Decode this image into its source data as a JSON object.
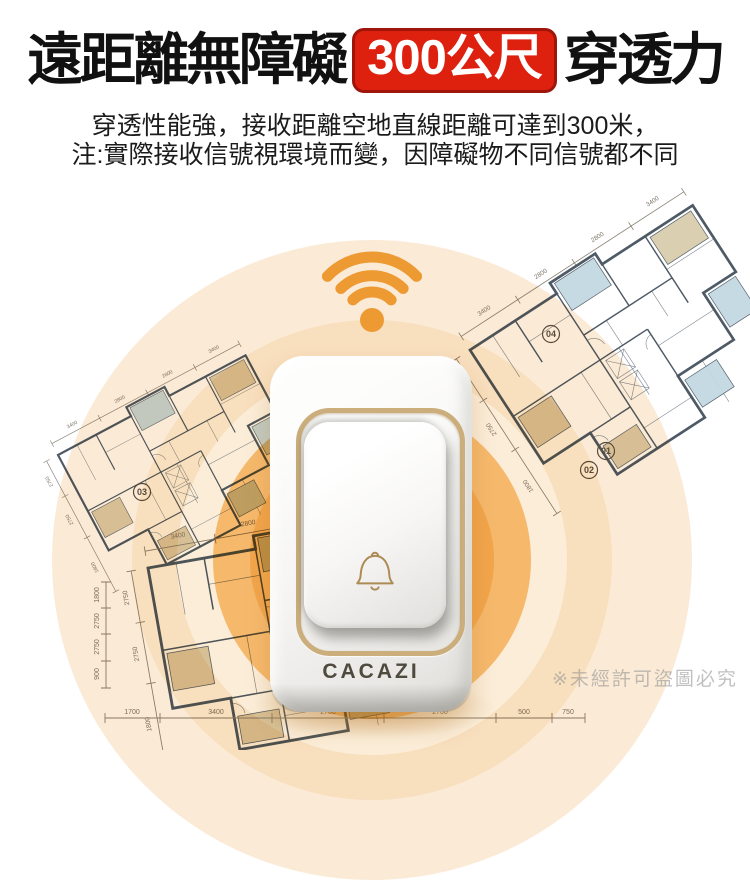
{
  "header": {
    "title_left": "遠距離無障礙",
    "badge": "300公尺",
    "title_right": "穿透力",
    "subtitle_line1": "穿透性能強，接收距離空地直線距離可達到300米，",
    "subtitle_line2": "注:實際接收信號視環境而變，因障礙物不同信號都不同"
  },
  "device": {
    "brand": "CACAZI"
  },
  "scene": {
    "watermark": "※未經許可盜圖必究"
  },
  "icons": {
    "wifi": "wifi-signal-icon",
    "bell": "doorbell-bell-icon"
  },
  "floorplan": {
    "unit_labels": [
      "04",
      "01",
      "02",
      "03"
    ],
    "plan_dims": [
      "3400",
      "2800",
      "2800",
      "3400",
      "2750",
      "2750",
      "1800"
    ],
    "bottom_dims": [
      "1700",
      "3400",
      "2700",
      "2700",
      "500",
      "750"
    ],
    "left_dims": [
      "1800",
      "2750",
      "2750",
      "900"
    ]
  },
  "colors": {
    "headline": "#111111",
    "badge_bg": "#DE200F",
    "badge_border": "#9E150A",
    "signal_orange": "#EE9A33",
    "ring_pale1": "#FBEAD6",
    "ring_pale2": "#F8DFBE",
    "ring_cream": "#FBEDD8",
    "ring_mid": "#F6B96C",
    "ring_deep": "#F2A54B",
    "gold": "#CBAE7C",
    "brand_text": "#4E4A3E",
    "plan_wall": "#4E5A66",
    "room_blue": "#C2D8E2",
    "room_tan": "#DACDAD",
    "watermark_gray": "#8E8E8E"
  }
}
